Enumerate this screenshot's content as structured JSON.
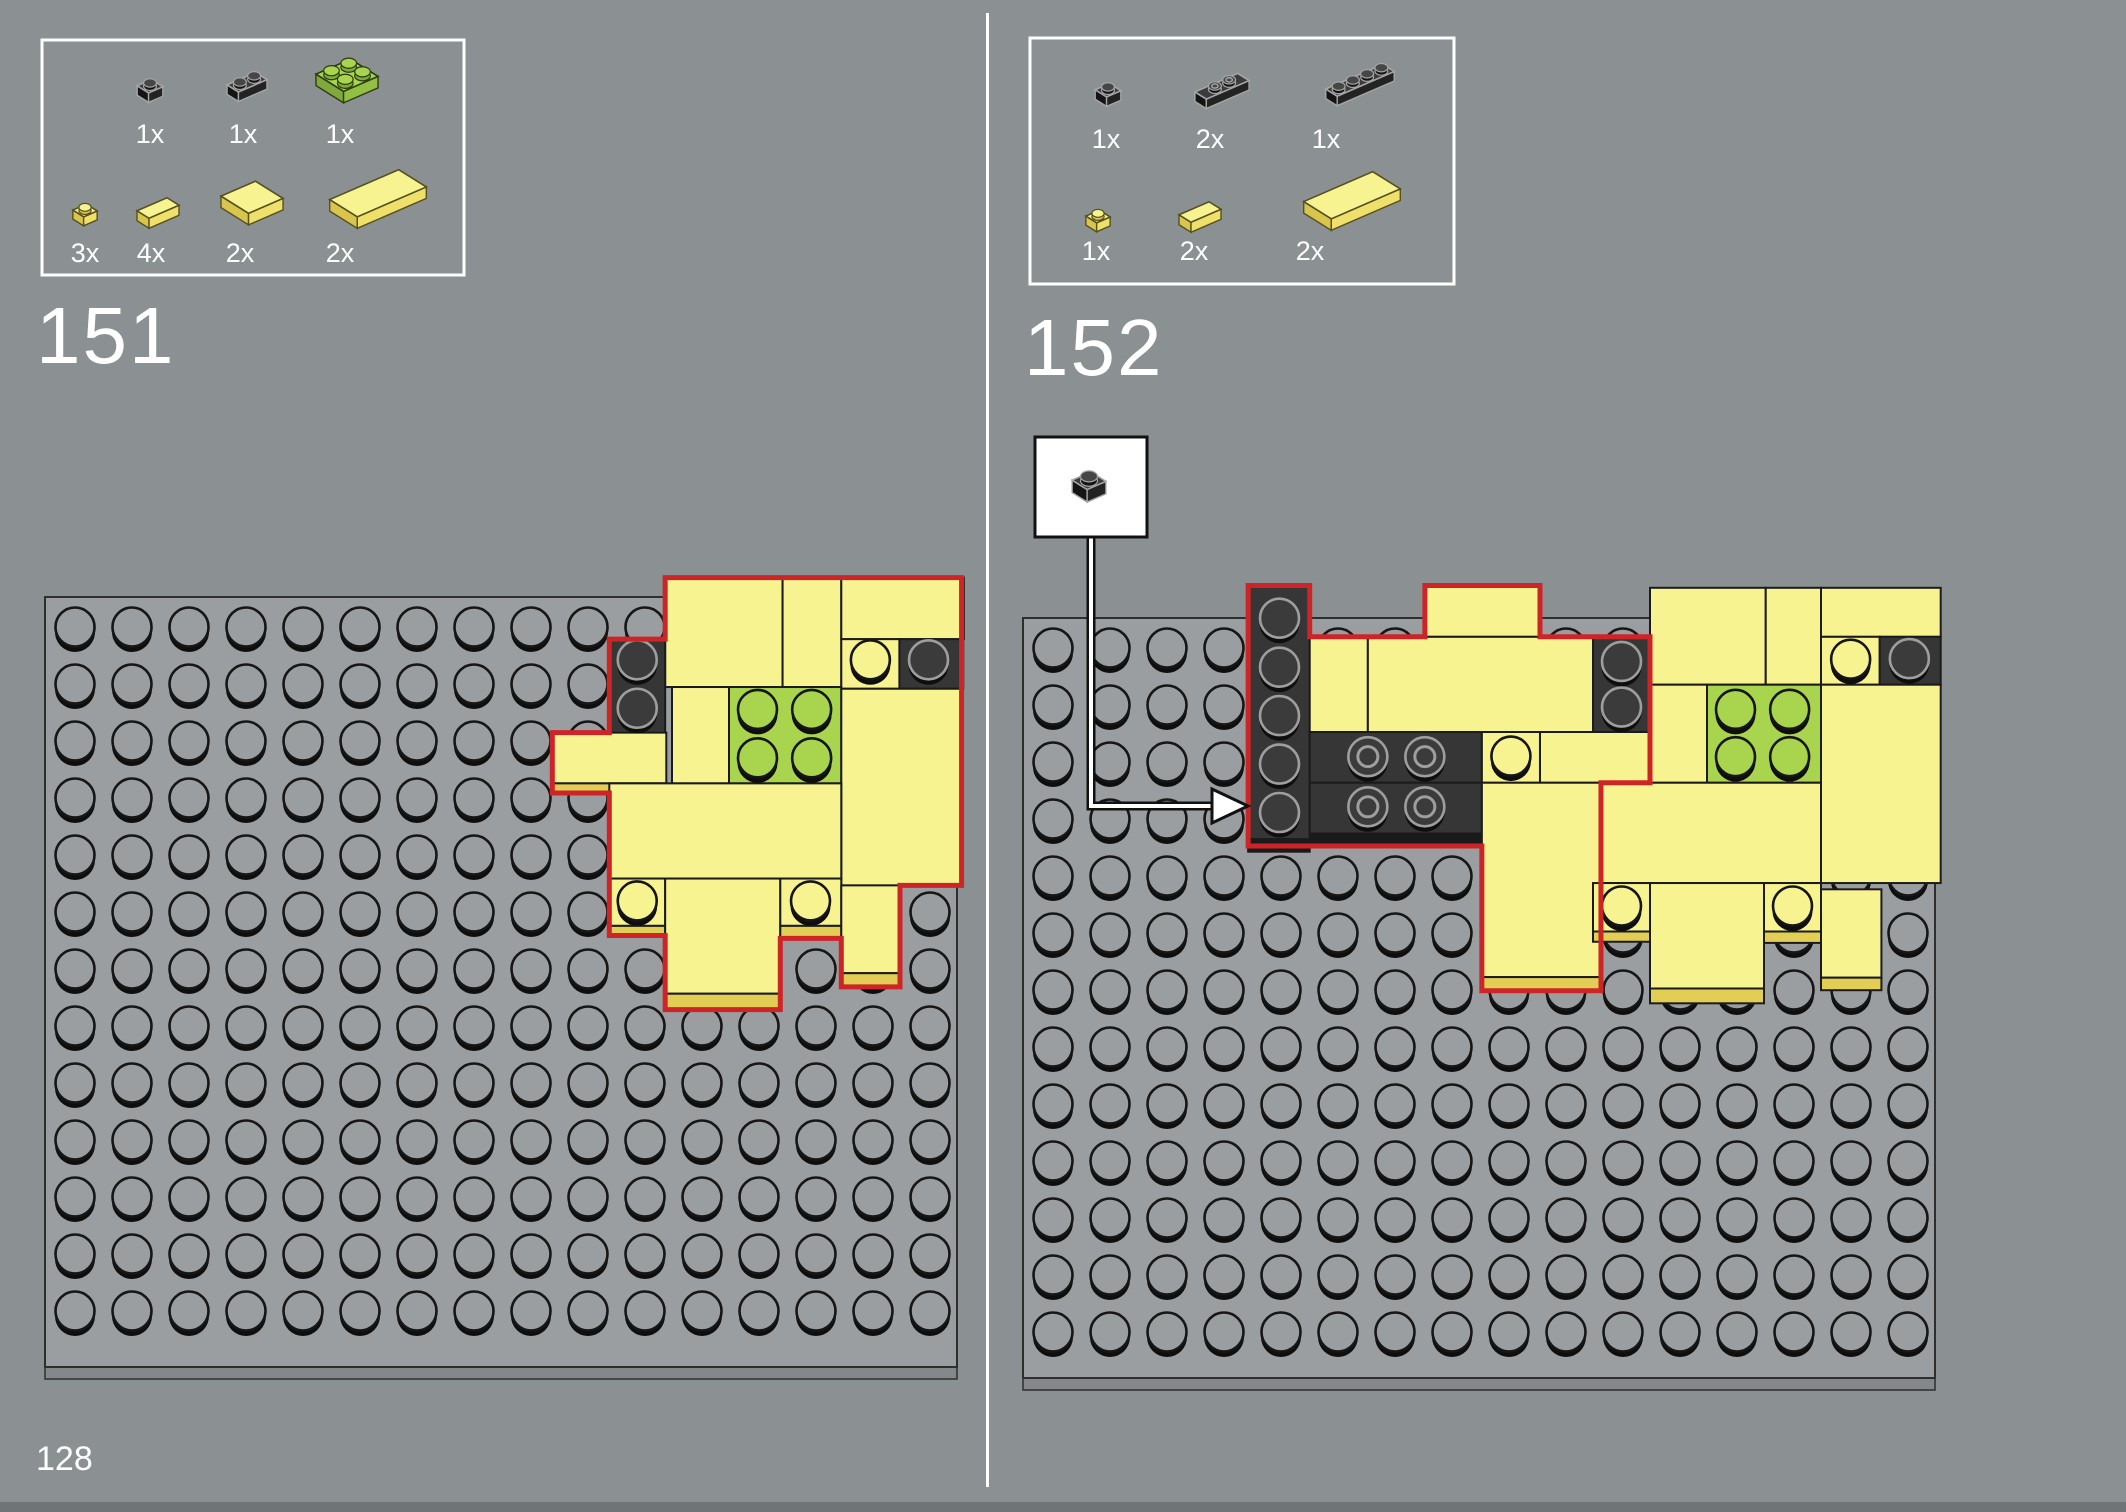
{
  "page": {
    "number": "128",
    "bg": "#8B9193",
    "divider": {
      "x": 986,
      "y": 13,
      "w": 3,
      "h": 1474,
      "color": "#FFFFFF"
    },
    "footer": {
      "h": 10,
      "color": "#6F7476"
    }
  },
  "colors": {
    "plate": "#9B9EA0",
    "plateEdge": "#85888A",
    "plateStroke": "#2E2E2E",
    "studStroke": "#161616",
    "shadow": "#0E0E0E",
    "yellow": "#F8F391",
    "yellowSide": "#E2CD55",
    "green": "#A8D44E",
    "black": "#363636",
    "blackSide": "#1A1A1A",
    "darkStudFill": "#3B3B3B",
    "darkStudStroke": "#9E9E9E",
    "red": "#CD2428",
    "white": "#FFFFFF",
    "calloutLine": "#111111"
  },
  "steps": [
    {
      "number": "151",
      "number_pos": {
        "x": 36,
        "y": 296
      },
      "parts_box": {
        "x": 42,
        "y": 40,
        "w": 422,
        "h": 235,
        "parts": [
          {
            "name": "black-plate-1x1",
            "label": "1x",
            "w": 1,
            "d": 1,
            "color": "black",
            "tile": false,
            "s": 0.95,
            "cx": 150,
            "cy": 88,
            "lx": 150,
            "ly": 143
          },
          {
            "name": "black-plate-1x2",
            "label": "1x",
            "w": 2,
            "d": 1,
            "color": "black",
            "tile": false,
            "s": 0.95,
            "cx": 247,
            "cy": 84,
            "lx": 243,
            "ly": 143
          },
          {
            "name": "green-plate-2x2",
            "label": "1x",
            "w": 2,
            "d": 2,
            "color": "green",
            "tile": false,
            "s": 1.15,
            "cx": 347,
            "cy": 78,
            "lx": 340,
            "ly": 143
          },
          {
            "name": "yellow-plate-1x1",
            "label": "3x",
            "w": 1,
            "d": 1,
            "color": "yellow",
            "tile": false,
            "s": 0.9,
            "cx": 85,
            "cy": 212,
            "lx": 85,
            "ly": 262
          },
          {
            "name": "yellow-tile-1x2",
            "label": "4x",
            "w": 2,
            "d": 1,
            "color": "yellow",
            "tile": true,
            "s": 1.0,
            "cx": 158,
            "cy": 210,
            "lx": 151,
            "ly": 262
          },
          {
            "name": "yellow-tile-2x2",
            "label": "2x",
            "w": 2,
            "d": 2,
            "color": "yellow",
            "tile": true,
            "s": 1.15,
            "cx": 252,
            "cy": 200,
            "lx": 240,
            "ly": 262
          },
          {
            "name": "yellow-tile-2x4",
            "label": "2x",
            "w": 4,
            "d": 2,
            "color": "yellow",
            "tile": true,
            "s": 1.15,
            "cx": 378,
            "cy": 196,
            "lx": 340,
            "ly": 262
          }
        ]
      },
      "plate": {
        "x": 45,
        "y": 597,
        "w": 912,
        "h": 770,
        "cols": 16,
        "rows": 13,
        "pitch": 57,
        "stud_x": 75,
        "stud_y": 628
      },
      "build_dy": -12,
      "pieces": [
        {
          "c": 10.88,
          "r": -0.13,
          "w": 2.06,
          "h": 1.92,
          "col": "Y"
        },
        {
          "c": 12.94,
          "r": -0.13,
          "w": 1.03,
          "h": 1.92,
          "col": "Y"
        },
        {
          "c": 13.97,
          "r": -0.13,
          "w": 2.15,
          "h": 1.08,
          "col": "Y"
        },
        {
          "c": 9.9,
          "r": 0.95,
          "w": 0.98,
          "h": 1.7,
          "col": "K",
          "studs": [
            [
              10.39,
              1.33,
              "dark"
            ],
            [
              10.39,
              2.18,
              "dark"
            ]
          ]
        },
        {
          "c": 13.97,
          "r": 0.95,
          "w": 1.02,
          "h": 0.87,
          "col": "Y",
          "studs": [
            [
              14.48,
              1.33,
              "yellow"
            ]
          ]
        },
        {
          "c": 14.99,
          "r": 0.95,
          "w": 1.12,
          "h": 0.87,
          "col": "K",
          "studs": [
            [
              15.5,
              1.33,
              "dark"
            ]
          ]
        },
        {
          "c": 11.0,
          "r": 1.79,
          "w": 1.0,
          "h": 1.69,
          "col": "Y"
        },
        {
          "c": 12.0,
          "r": 1.79,
          "w": 1.97,
          "h": 1.69,
          "col": "G",
          "studs": [
            [
              12.5,
              2.2,
              "green"
            ],
            [
              13.45,
              2.2,
              "green"
            ],
            [
              12.5,
              3.05,
              "green"
            ],
            [
              13.45,
              3.05,
              "green"
            ]
          ]
        },
        {
          "c": 8.9,
          "r": 2.59,
          "w": 2.0,
          "h": 0.89,
          "col": "Y"
        },
        {
          "c": 8.9,
          "r": 3.48,
          "w": 2.0,
          "h": 0.17,
          "col": "YS"
        },
        {
          "c": 13.97,
          "r": 1.82,
          "w": 2.11,
          "h": 3.45,
          "col": "Y"
        },
        {
          "c": 9.9,
          "r": 3.48,
          "w": 4.07,
          "h": 1.67,
          "col": "Y"
        },
        {
          "c": 9.9,
          "r": 5.15,
          "w": 0.98,
          "h": 0.83,
          "col": "Y",
          "studs": [
            [
              10.39,
              5.56,
              "yellow"
            ]
          ]
        },
        {
          "c": 9.9,
          "r": 5.98,
          "w": 0.98,
          "h": 0.17,
          "col": "YS"
        },
        {
          "c": 10.88,
          "r": 5.15,
          "w": 2.02,
          "h": 2.02,
          "col": "Y"
        },
        {
          "c": 10.88,
          "r": 7.17,
          "w": 2.02,
          "h": 0.28,
          "col": "YS"
        },
        {
          "c": 12.9,
          "r": 5.15,
          "w": 1.07,
          "h": 0.83,
          "col": "Y",
          "studs": [
            [
              13.43,
              5.56,
              "yellow"
            ]
          ]
        },
        {
          "c": 12.9,
          "r": 5.98,
          "w": 1.07,
          "h": 0.22,
          "col": "YS"
        },
        {
          "c": 13.97,
          "r": 5.27,
          "w": 1.03,
          "h": 1.54,
          "col": "Y"
        },
        {
          "c": 13.97,
          "r": 6.81,
          "w": 1.03,
          "h": 0.24,
          "col": "YS"
        }
      ],
      "outline": [
        [
          10.88,
          -0.13
        ],
        [
          16.08,
          -0.13
        ],
        [
          16.08,
          5.27
        ],
        [
          15.0,
          5.27
        ],
        [
          15.0,
          7.05
        ],
        [
          13.97,
          7.05
        ],
        [
          13.97,
          6.2
        ],
        [
          12.9,
          6.2
        ],
        [
          12.9,
          7.45
        ],
        [
          10.88,
          7.45
        ],
        [
          10.88,
          6.15
        ],
        [
          9.9,
          6.15
        ],
        [
          9.9,
          3.65
        ],
        [
          8.9,
          3.65
        ],
        [
          8.9,
          2.59
        ],
        [
          9.9,
          2.59
        ],
        [
          9.9,
          0.95
        ],
        [
          10.88,
          0.95
        ]
      ],
      "callout": null
    },
    {
      "number": "152",
      "number_pos": {
        "x": 1024,
        "y": 308
      },
      "parts_box": {
        "x": 1030,
        "y": 38,
        "w": 424,
        "h": 246,
        "parts": [
          {
            "name": "black-plate-1x1",
            "label": "1x",
            "w": 1,
            "d": 1,
            "color": "black",
            "tile": false,
            "s": 0.95,
            "cx": 1108,
            "cy": 92,
            "lx": 1106,
            "ly": 148
          },
          {
            "name": "black-jumper-plate-1x3",
            "label": "2x",
            "w": 3,
            "d": 1,
            "color": "black",
            "tile": false,
            "s": 0.95,
            "cx": 1222,
            "cy": 88,
            "lx": 1210,
            "ly": 148,
            "hollow": true,
            "studPos": [
              [
                1.0,
                0.5
              ],
              [
                2.0,
                0.5
              ]
            ]
          },
          {
            "name": "black-plate-1x4",
            "label": "1x",
            "w": 4,
            "d": 1,
            "color": "black",
            "tile": false,
            "s": 0.95,
            "cx": 1360,
            "cy": 82,
            "lx": 1326,
            "ly": 148
          },
          {
            "name": "yellow-plate-1x1",
            "label": "1x",
            "w": 1,
            "d": 1,
            "color": "yellow",
            "tile": false,
            "s": 0.9,
            "cx": 1098,
            "cy": 218,
            "lx": 1096,
            "ly": 260
          },
          {
            "name": "yellow-tile-1x2",
            "label": "2x",
            "w": 2,
            "d": 1,
            "color": "yellow",
            "tile": true,
            "s": 1.0,
            "cx": 1200,
            "cy": 214,
            "lx": 1194,
            "ly": 260
          },
          {
            "name": "yellow-tile-2x4",
            "label": "2x",
            "w": 4,
            "d": 2,
            "color": "yellow",
            "tile": true,
            "s": 1.15,
            "cx": 1352,
            "cy": 198,
            "lx": 1310,
            "ly": 260
          }
        ]
      },
      "plate": {
        "x": 1023,
        "y": 618,
        "w": 912,
        "h": 760,
        "cols": 16,
        "rows": 13,
        "pitch": 57,
        "stud_x": 1053,
        "stud_y": 649
      },
      "build_dy": 0,
      "pieces": [
        {
          "c": 3.95,
          "r": -0.57,
          "w": 1.08,
          "h": 4.45,
          "col": "K",
          "studs": [
            [
              4.5,
              0.02,
              "dark"
            ],
            [
              4.5,
              0.88,
              "dark"
            ],
            [
              4.5,
              1.73,
              "dark"
            ],
            [
              4.5,
              2.58,
              "dark"
            ],
            [
              4.5,
              3.43,
              "dark"
            ]
          ]
        },
        {
          "c": 3.95,
          "r": 3.88,
          "w": 1.08,
          "h": 0.22,
          "col": "KS"
        },
        {
          "c": 5.03,
          "r": 2.0,
          "w": 3.02,
          "h": 0.89,
          "col": "K",
          "studs": [
            [
              6.05,
              2.45,
              "hollow"
            ],
            [
              7.05,
              2.45,
              "hollow"
            ]
          ]
        },
        {
          "c": 5.03,
          "r": 2.89,
          "w": 3.02,
          "h": 0.89,
          "col": "K",
          "studs": [
            [
              6.05,
              3.33,
              "hollow"
            ],
            [
              7.05,
              3.33,
              "hollow"
            ]
          ]
        },
        {
          "c": 5.03,
          "r": 3.78,
          "w": 3.02,
          "h": 0.22,
          "col": "KS"
        },
        {
          "c": 7.05,
          "r": -0.57,
          "w": 2.02,
          "h": 0.9,
          "col": "Y"
        },
        {
          "c": 5.03,
          "r": 0.33,
          "w": 1.02,
          "h": 1.67,
          "col": "Y"
        },
        {
          "c": 6.05,
          "r": 0.33,
          "w": 3.95,
          "h": 1.67,
          "col": "Y"
        },
        {
          "c": 10.0,
          "r": 0.33,
          "w": 1.0,
          "h": 1.7,
          "col": "K",
          "studs": [
            [
              10.5,
              0.78,
              "dark"
            ],
            [
              10.5,
              1.58,
              "dark"
            ]
          ]
        },
        {
          "c": 8.05,
          "r": 2.0,
          "w": 1.02,
          "h": 0.89,
          "col": "Y",
          "studs": [
            [
              8.56,
              2.44,
              "yellow"
            ]
          ]
        },
        {
          "c": 9.07,
          "r": 2.0,
          "w": 1.93,
          "h": 0.89,
          "col": "Y"
        },
        {
          "c": 8.05,
          "r": 2.89,
          "w": 2.09,
          "h": 3.41,
          "col": "Y"
        },
        {
          "c": 8.05,
          "r": 6.3,
          "w": 2.09,
          "h": 0.24,
          "col": "YS"
        },
        {
          "c": 11.0,
          "r": -0.53,
          "w": 2.03,
          "h": 1.7,
          "col": "Y"
        },
        {
          "c": 13.03,
          "r": -0.53,
          "w": 0.97,
          "h": 1.7,
          "col": "Y"
        },
        {
          "c": 14.0,
          "r": -0.53,
          "w": 2.1,
          "h": 0.86,
          "col": "Y"
        },
        {
          "c": 14.0,
          "r": 0.33,
          "w": 1.03,
          "h": 0.84,
          "col": "Y",
          "studs": [
            [
              14.52,
              0.74,
              "yellow"
            ]
          ]
        },
        {
          "c": 15.03,
          "r": 0.33,
          "w": 1.07,
          "h": 0.84,
          "col": "K",
          "studs": [
            [
              15.55,
              0.73,
              "dark"
            ]
          ]
        },
        {
          "c": 11.0,
          "r": 1.17,
          "w": 1.0,
          "h": 1.72,
          "col": "Y"
        },
        {
          "c": 12.0,
          "r": 1.17,
          "w": 2.0,
          "h": 1.72,
          "col": "G",
          "studs": [
            [
              12.5,
              1.62,
              "green"
            ],
            [
              13.45,
              1.62,
              "green"
            ],
            [
              12.5,
              2.45,
              "green"
            ],
            [
              13.45,
              2.45,
              "green"
            ]
          ]
        },
        {
          "c": 14.0,
          "r": 1.17,
          "w": 2.1,
          "h": 3.48,
          "col": "Y"
        },
        {
          "c": 10.14,
          "r": 2.89,
          "w": 3.86,
          "h": 1.76,
          "col": "Y"
        },
        {
          "c": 10.0,
          "r": 4.65,
          "w": 1.0,
          "h": 0.85,
          "col": "Y",
          "studs": [
            [
              10.5,
              5.07,
              "yellow"
            ]
          ]
        },
        {
          "c": 10.0,
          "r": 5.5,
          "w": 1.0,
          "h": 0.18,
          "col": "YS"
        },
        {
          "c": 11.0,
          "r": 4.65,
          "w": 2.0,
          "h": 1.85,
          "col": "Y"
        },
        {
          "c": 11.0,
          "r": 6.5,
          "w": 2.0,
          "h": 0.26,
          "col": "YS"
        },
        {
          "c": 13.0,
          "r": 4.65,
          "w": 1.0,
          "h": 0.85,
          "col": "Y",
          "studs": [
            [
              13.5,
              5.07,
              "yellow"
            ]
          ]
        },
        {
          "c": 13.0,
          "r": 5.5,
          "w": 1.0,
          "h": 0.2,
          "col": "YS"
        },
        {
          "c": 14.0,
          "r": 4.76,
          "w": 1.06,
          "h": 1.55,
          "col": "Y"
        },
        {
          "c": 14.0,
          "r": 6.31,
          "w": 1.06,
          "h": 0.22,
          "col": "YS"
        }
      ],
      "outline": [
        [
          3.95,
          -0.57
        ],
        [
          5.03,
          -0.57
        ],
        [
          5.03,
          0.33
        ],
        [
          7.05,
          0.33
        ],
        [
          7.05,
          -0.57
        ],
        [
          9.07,
          -0.57
        ],
        [
          9.07,
          0.33
        ],
        [
          11.0,
          0.33
        ],
        [
          11.0,
          2.89
        ],
        [
          10.14,
          2.89
        ],
        [
          10.14,
          6.54
        ],
        [
          8.05,
          6.54
        ],
        [
          8.05,
          4.0
        ],
        [
          3.95,
          4.0
        ]
      ],
      "callout": {
        "box": {
          "x": 1035,
          "y": 437,
          "w": 112,
          "h": 100
        },
        "part": {
          "name": "black-plate-1x1",
          "w": 1,
          "d": 1,
          "color": "black",
          "tile": false,
          "s": 1.25,
          "cx": 1089,
          "cy": 484
        },
        "line": [
          [
            1091,
            537
          ],
          [
            1091,
            806
          ],
          [
            1216,
            806
          ]
        ],
        "arrow": [
          [
            1212,
            789
          ],
          [
            1248,
            806
          ],
          [
            1212,
            823
          ]
        ]
      }
    }
  ]
}
